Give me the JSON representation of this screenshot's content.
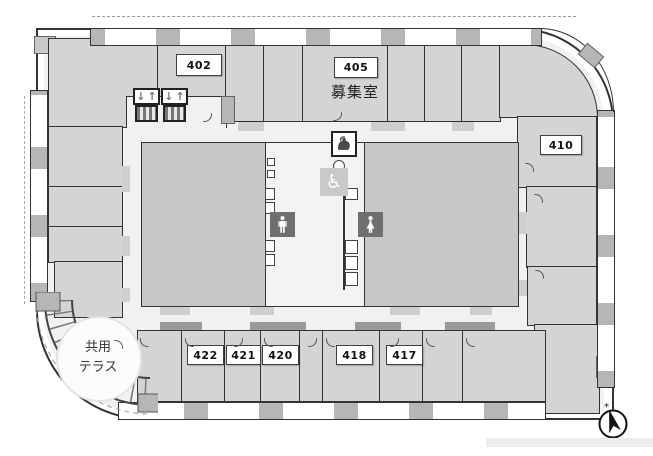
{
  "colors": {
    "wall": "#333333",
    "room_fill": "#d4d4d4",
    "main_room_fill": "#c7c7c7",
    "corridor_fill": "#f1f1f1",
    "core_fill": "#f3f3f3",
    "column_fill": "#b6b6b6",
    "toilet_icon_box_fill": "#6f6f6f",
    "accessible_box_fill": "#c9c9c9"
  },
  "rooms": {
    "r402": {
      "label": "402"
    },
    "r405": {
      "label": "405"
    },
    "r410": {
      "label": "410"
    },
    "r417": {
      "label": "417"
    },
    "r418": {
      "label": "418"
    },
    "r420": {
      "label": "420"
    },
    "r421": {
      "label": "421"
    },
    "r422": {
      "label": "422"
    }
  },
  "annotations": {
    "vacancy_room_label": "募集室",
    "shared_terrace_line1": "共用",
    "shared_terrace_line2": "テラス"
  },
  "icons": {
    "elevator_down_arrow": "↓",
    "elevator_up_arrow": "↑",
    "accessible_toilet_symbol": "♿",
    "compass_mark": "*"
  }
}
